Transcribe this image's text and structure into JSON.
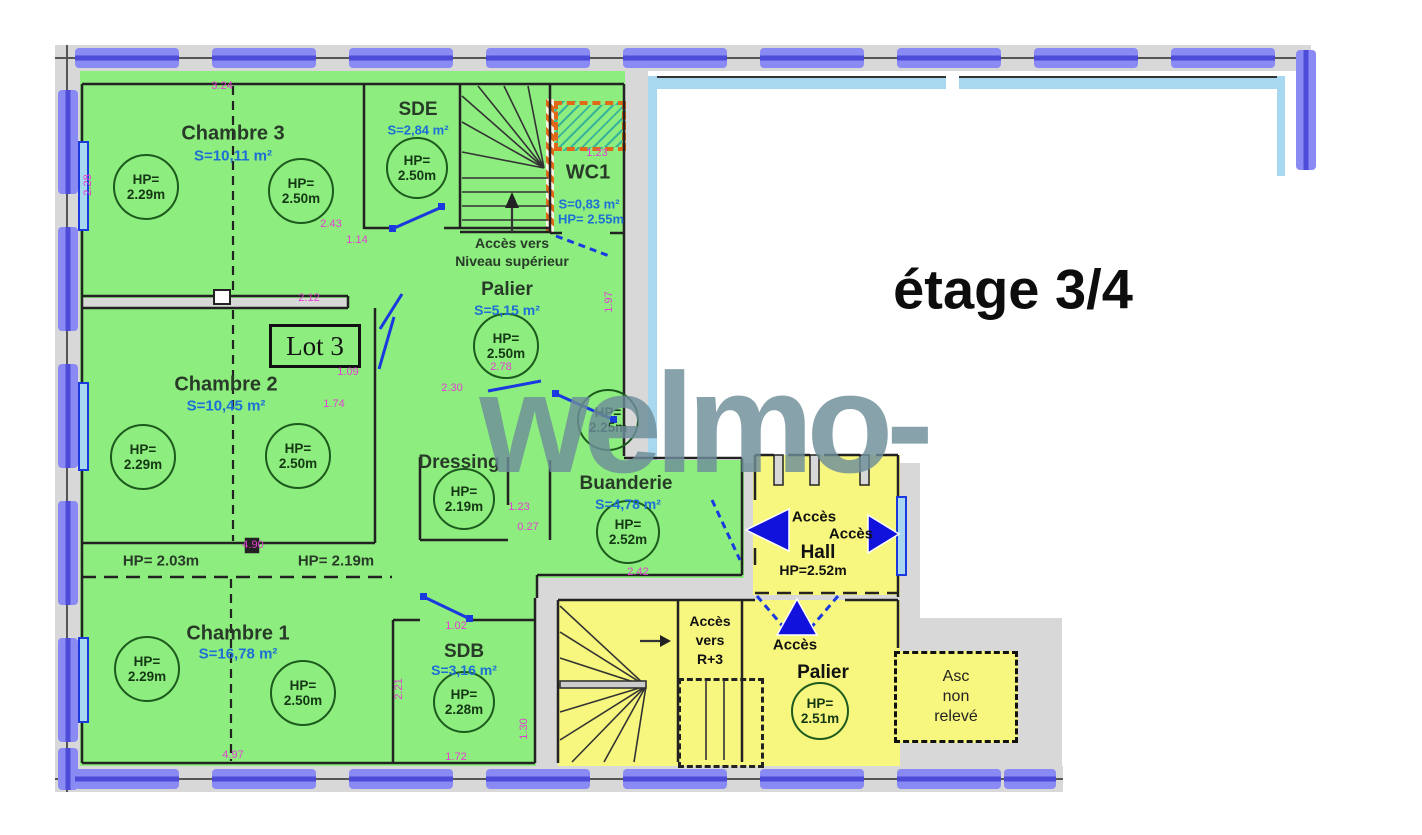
{
  "title": "étage 3/4",
  "watermark": "welmo-",
  "lot": "Lot 3",
  "rooms": {
    "chambre3": {
      "name": "Chambre 3",
      "area": "S=10,11 m²"
    },
    "sde": {
      "name": "SDE",
      "area": "S=2,84 m²"
    },
    "wc1": {
      "name": "WC1",
      "area": "S=0,83 m²",
      "hp": "HP= 2.55m"
    },
    "palier_haut": {
      "name": "Palier",
      "area": "S=5,15 m²"
    },
    "chambre2": {
      "name": "Chambre 2",
      "area": "S=10,45 m²"
    },
    "dressing": {
      "name": "Dressing"
    },
    "buanderie": {
      "name": "Buanderie",
      "area": "S=4,78 m²"
    },
    "chambre1": {
      "name": "Chambre 1",
      "area": "S=16,78 m²"
    },
    "sdb": {
      "name": "SDB",
      "area": "S=3,16 m²"
    },
    "hall": {
      "name": "Hall",
      "hp": "HP=2.52m"
    },
    "palier_bas": {
      "name": "Palier"
    },
    "ascenseur": {
      "lines": [
        "Asc",
        "non",
        "relevé"
      ]
    }
  },
  "hp_circles": [
    {
      "label": "HP=",
      "value": "2.29m"
    },
    {
      "label": "HP=",
      "value": "2.50m"
    },
    {
      "label": "HP=",
      "value": "2.50m"
    },
    {
      "label": "HP=",
      "value": "2.50m"
    },
    {
      "label": "HP=",
      "value": "2.29m"
    },
    {
      "label": "HP=",
      "value": "2.50m"
    },
    {
      "label": "HP=",
      "value": "2.25m"
    },
    {
      "label": "HP=",
      "value": "2.19m"
    },
    {
      "label": "HP=",
      "value": "2.52m"
    },
    {
      "label": "HP=",
      "value": "2.29m"
    },
    {
      "label": "HP=",
      "value": "2.50m"
    },
    {
      "label": "HP=",
      "value": "2.28m"
    },
    {
      "label": "HP=",
      "value": "2.51m"
    }
  ],
  "hp_texts": [
    "HP= 2.03m",
    "HP= 2.19m"
  ],
  "access": {
    "niveau_sup": [
      "Accès vers",
      "Niveau supérieur"
    ],
    "r3": [
      "Accès",
      "vers",
      "R+3"
    ],
    "hall_gauche": "Accès",
    "hall_droite": "Accès",
    "palier_montee": "Accès"
  },
  "dimensions": [
    "3.24",
    "2.28",
    "2.43",
    "1.14",
    "2.12",
    "1.09",
    "1.74",
    "2.78",
    "2.30",
    "1.97",
    "4.90",
    "1.23",
    "0.27",
    "2.42",
    "1.02",
    "2.21",
    "1.72",
    "4.97",
    "1.30",
    "1.23"
  ],
  "colors": {
    "apartment_green": "#8ded7e",
    "common_yellow": "#f7f67e",
    "wall_gray": "#d8d8d8",
    "boundary_blue": "#7d7df2",
    "dimension_pink": "#e33fd2",
    "area_text_blue": "#1d6fd6",
    "door_blue": "#1a3ae0",
    "watermark_gray": "#6e8e9b"
  }
}
